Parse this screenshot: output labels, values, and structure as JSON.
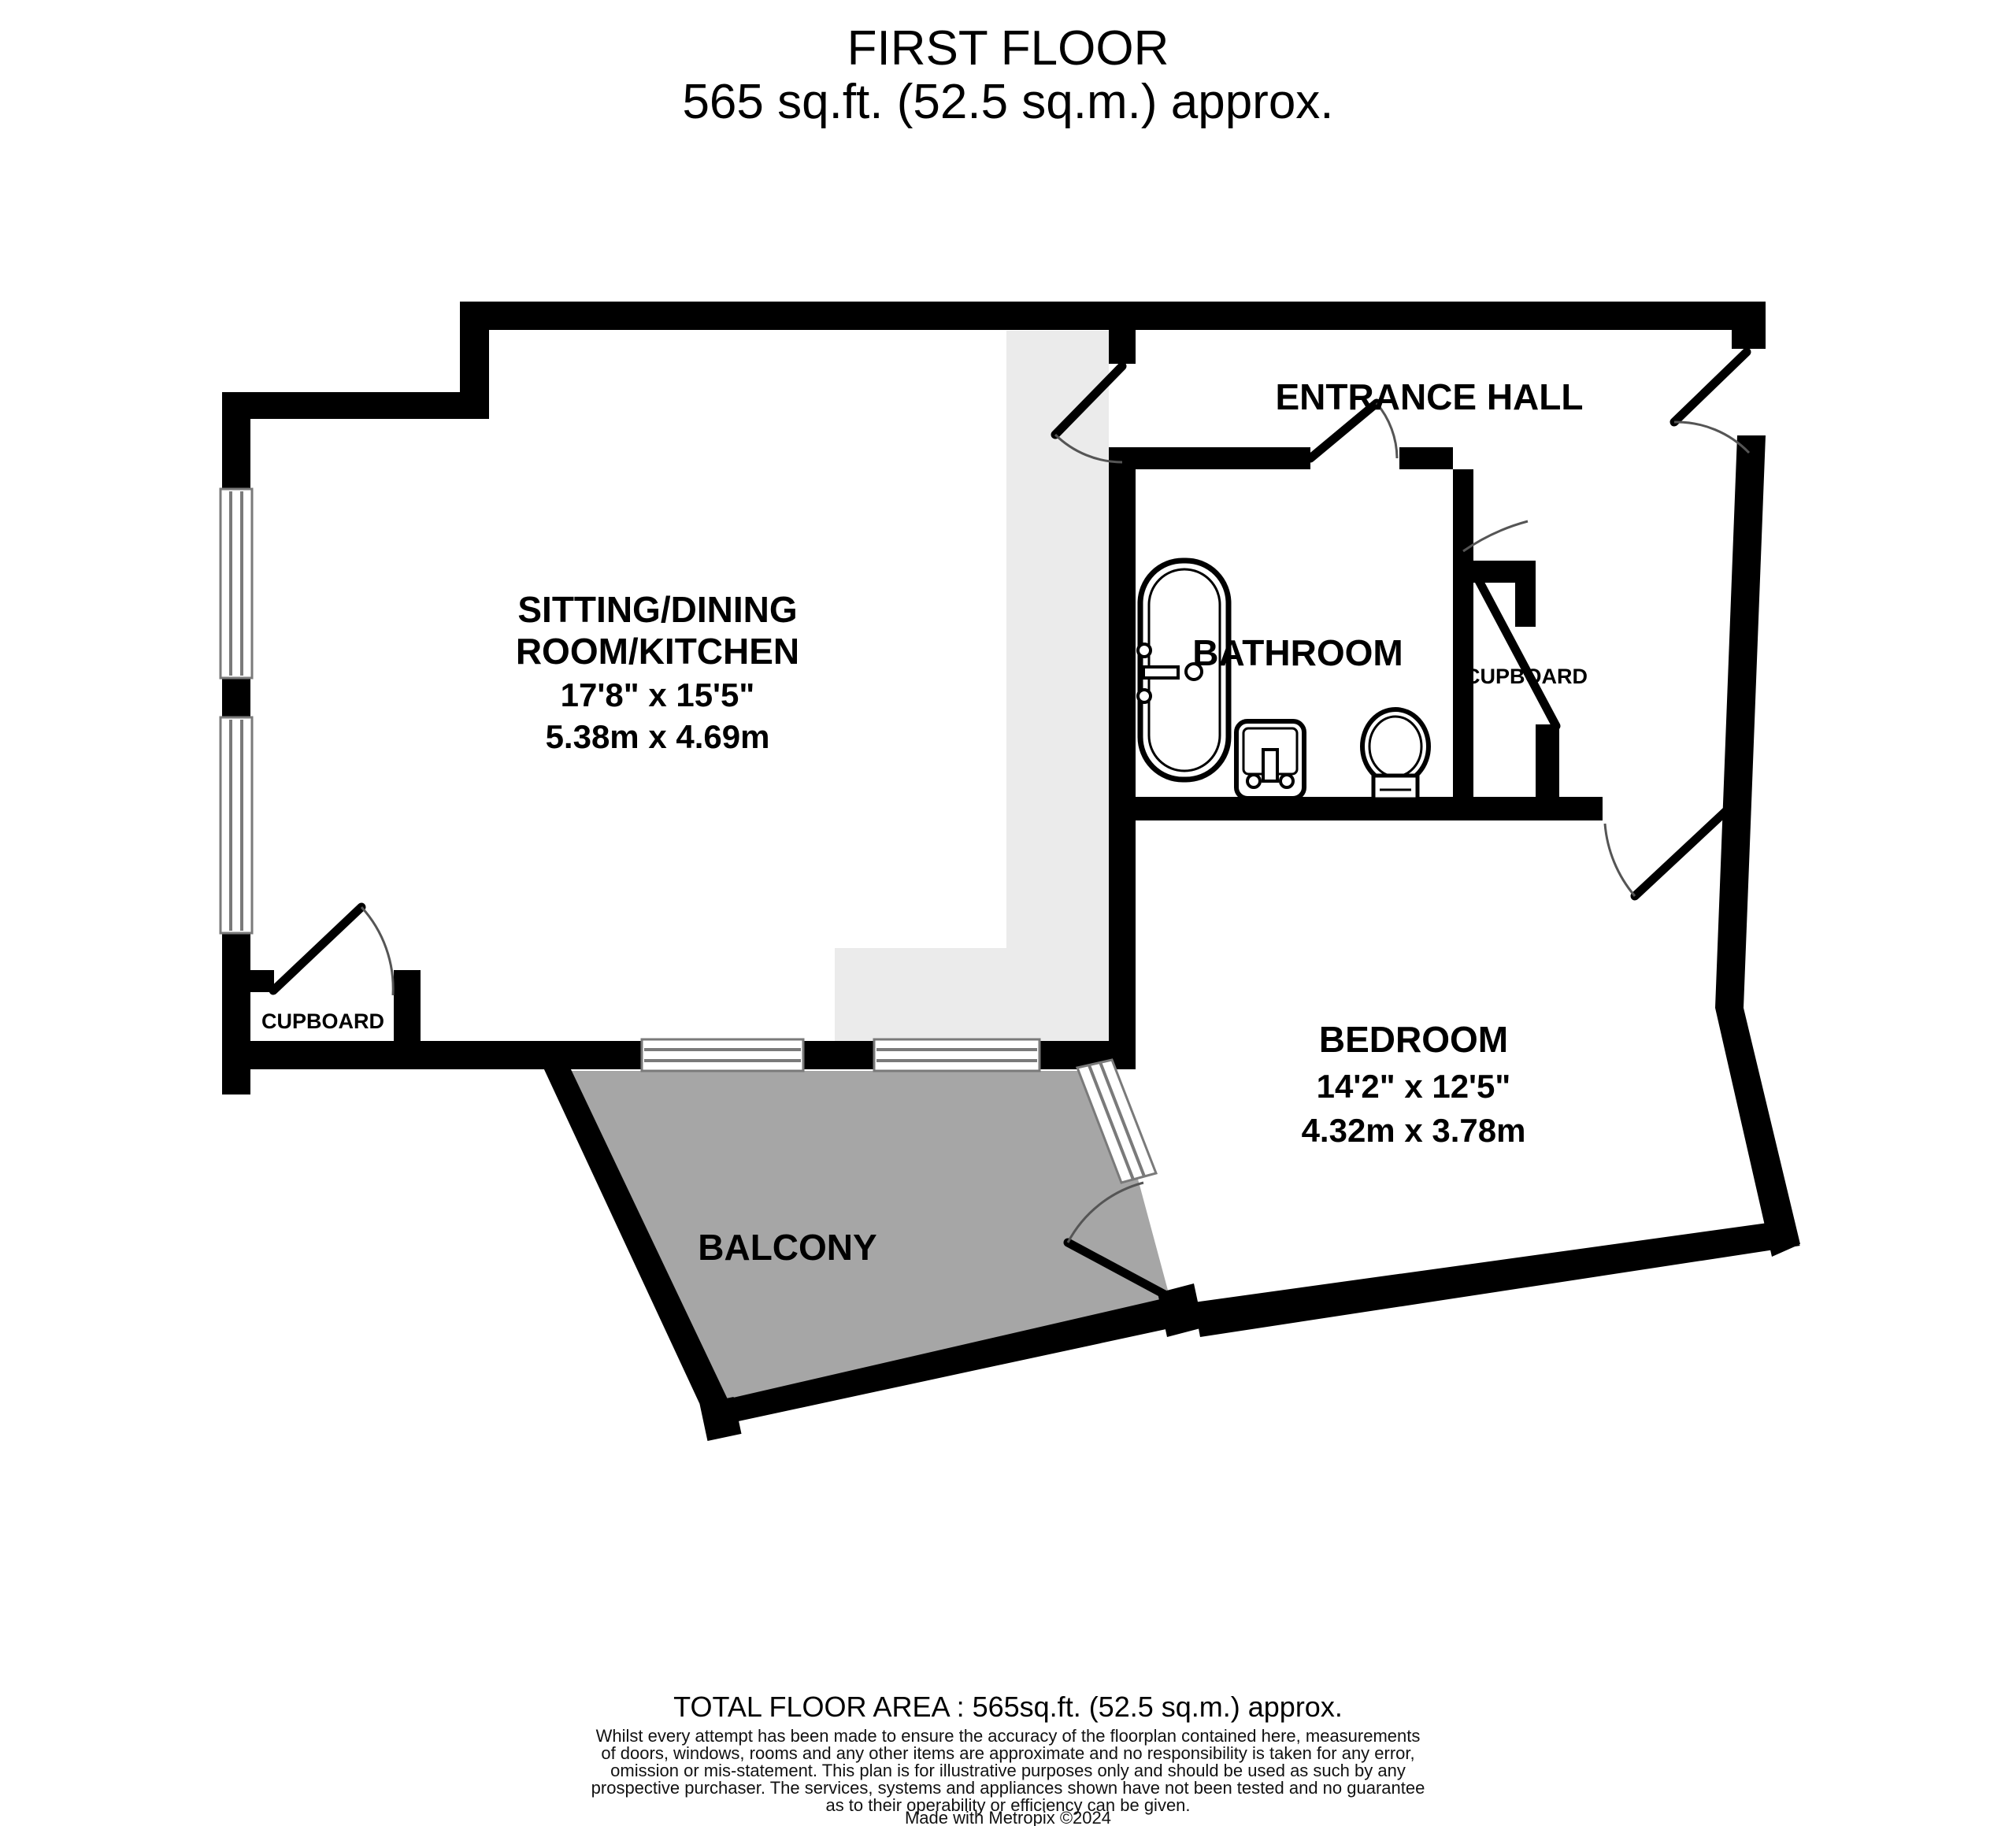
{
  "title": {
    "line1": "FIRST FLOOR",
    "line2": "565 sq.ft. (52.5 sq.m.) approx."
  },
  "rooms": {
    "sitting": {
      "name_line1": "SITTING/DINING",
      "name_line2": "ROOM/KITCHEN",
      "dims_imperial": "17'8\"  x 15'5\"",
      "dims_metric": "5.38m  x 4.69m"
    },
    "entrance_hall": {
      "name": "ENTRANCE HALL"
    },
    "bathroom": {
      "name": "BATHROOM"
    },
    "cupboard_hall": {
      "name": "CUPBOARD"
    },
    "cupboard_sitting": {
      "name": "CUPBOARD"
    },
    "bedroom": {
      "name": "BEDROOM",
      "dims_imperial": "14'2\"  x 12'5\"",
      "dims_metric": "4.32m  x 3.78m"
    },
    "balcony": {
      "name": "BALCONY"
    }
  },
  "footer": {
    "total_area": "TOTAL FLOOR AREA : 565sq.ft. (52.5 sq.m.) approx.",
    "disclaimer_lines": [
      "Whilst every attempt has been made to ensure the accuracy of the floorplan contained here, measurements",
      "of doors, windows, rooms and any other items are approximate and no responsibility is taken for any error,",
      "omission or mis-statement. This plan is for illustrative purposes only and should be used as such by any",
      "prospective purchaser. The services, systems and appliances shown have not been tested and no guarantee",
      "as to their operability or efficiency can be given."
    ],
    "credit": "Made with Metropix ©2024"
  },
  "colors": {
    "wall": "#000000",
    "balcony_fill": "#a6a6a6",
    "kitchen_fill": "#ebebeb",
    "window_line": "#7a7a7a"
  }
}
